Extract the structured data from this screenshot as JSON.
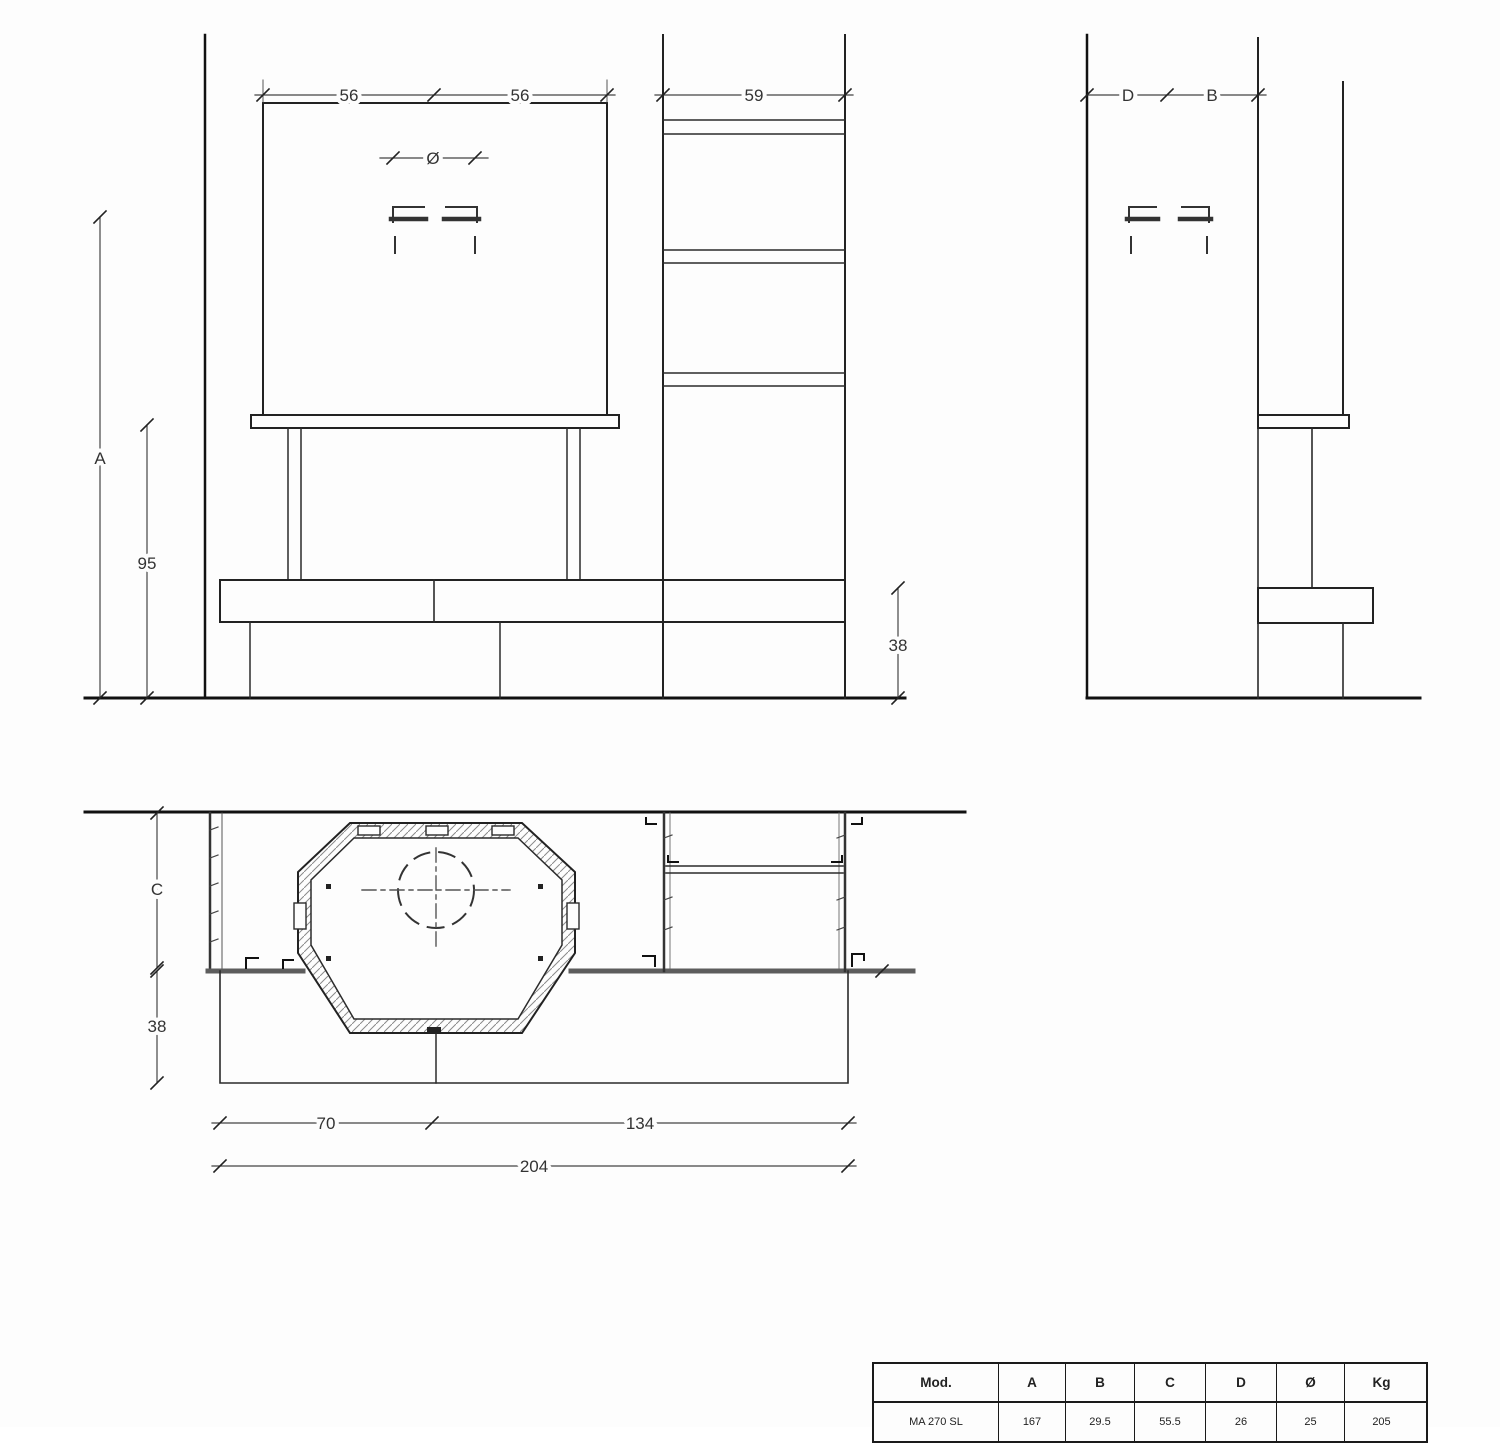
{
  "drawing": {
    "front_view": {
      "dim_hood_left": "56",
      "dim_hood_right": "56",
      "dim_column_width": "59",
      "dim_flue_diameter": "Ø",
      "dim_total_height": "A",
      "dim_hood_height": "95",
      "dim_bench_height": "38"
    },
    "side_view": {
      "dim_wall_gap": "D",
      "dim_depth": "B"
    },
    "plan_view": {
      "dim_depth": "C",
      "dim_bench_depth": "38",
      "dim_firebox_width": "70",
      "dim_right_width": "134",
      "dim_total_width": "204"
    }
  },
  "spec_table": {
    "headers": [
      "Mod.",
      "A",
      "B",
      "C",
      "D",
      "Ø",
      "Kg"
    ],
    "rows": [
      [
        "MA 270 SL",
        "167",
        "29.5",
        "55.5",
        "26",
        "25",
        "205"
      ]
    ]
  }
}
